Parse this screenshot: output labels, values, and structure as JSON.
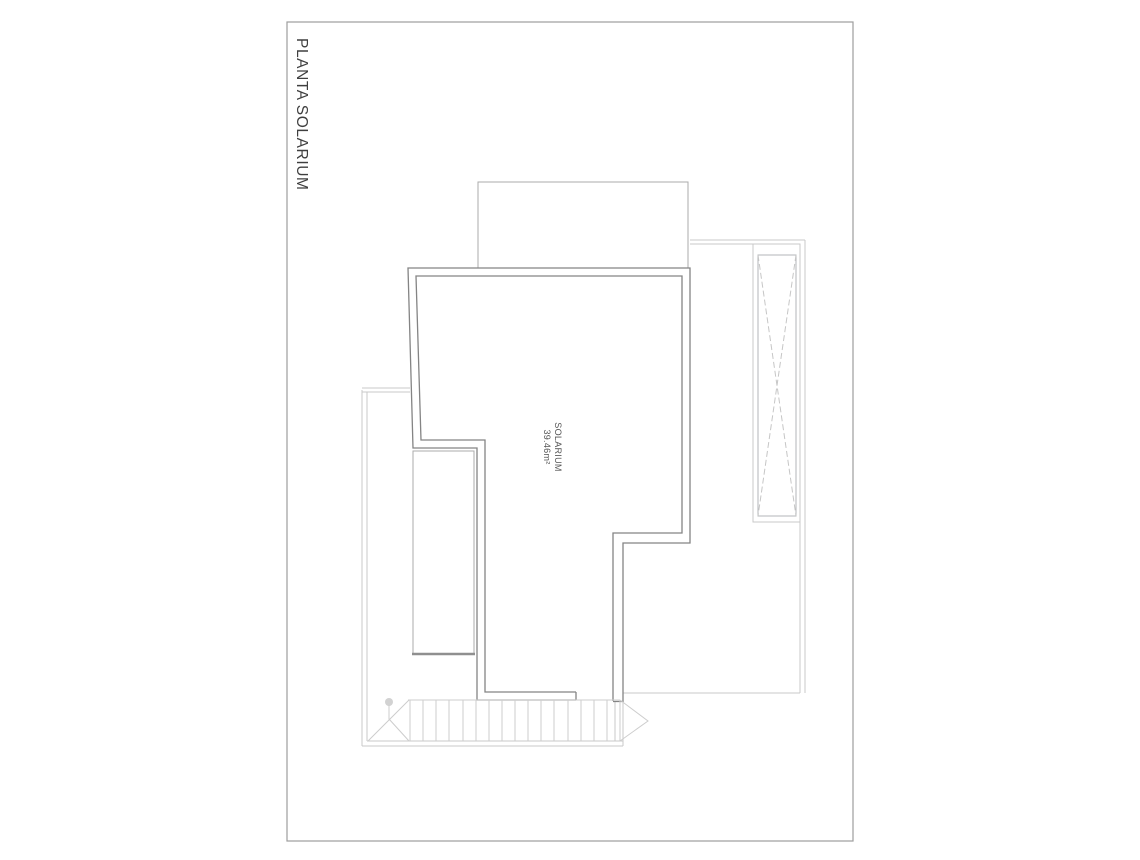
{
  "sheet": {
    "title": "PLANTA SOLARIUM"
  },
  "room": {
    "name": "SOLARIUM",
    "area": "39.46m²"
  },
  "palette": {
    "paper": "#ffffff",
    "sheet_border": "#9d9d9d",
    "wall_line": "#848484",
    "thin_line": "#c9c9c9",
    "medium_line": "#ababab",
    "roof_edge": "#8f8f8f",
    "title_text": "#3f3f3f",
    "label_text": "#555555"
  }
}
